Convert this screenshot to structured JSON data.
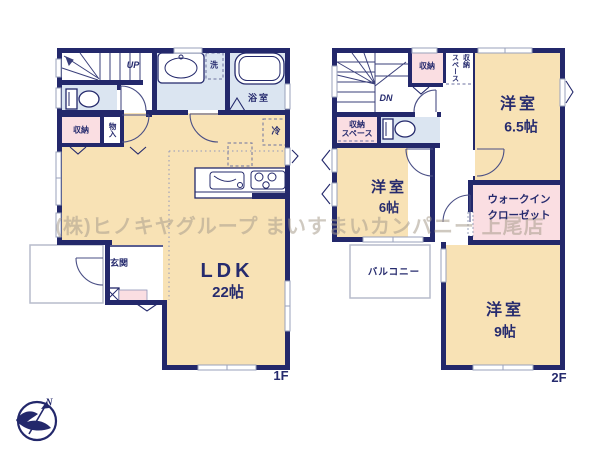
{
  "watermark": "(株)ヒノキヤグループ まいすまいカンパニー 上尾店",
  "floor1": {
    "floor_label": "1F",
    "stairs_label": "UP",
    "ldk_name": "LDK",
    "ldk_size": "22帖",
    "entrance": "玄関",
    "bathroom": "浴室",
    "laundry": "洗",
    "storage": "収納",
    "closet": "物入",
    "fridge": "冷"
  },
  "floor2": {
    "floor_label": "2F",
    "stairs_label": "DN",
    "room65_name": "洋室",
    "room65_size": "6.5帖",
    "room6_name": "洋室",
    "room6_size": "6帖",
    "room9_name": "洋室",
    "room9_size": "9帖",
    "wic_line1": "ウォークイン",
    "wic_line2": "クローゼット",
    "balcony": "バルコニー",
    "storage": "収納",
    "storage_space_col1": "スペース",
    "storage_space_col2": "収納",
    "storage_space_line1": "収納",
    "storage_space_line2": "スペース"
  },
  "compass": {
    "north": "N"
  },
  "colors": {
    "wall": "#23286b",
    "room_cream": "#f8e2b5",
    "wet_blue": "#dbe5f1",
    "closet_pink": "#fadee2",
    "window_gray": "#9aa2bb",
    "label_navy": "#262b6e"
  }
}
